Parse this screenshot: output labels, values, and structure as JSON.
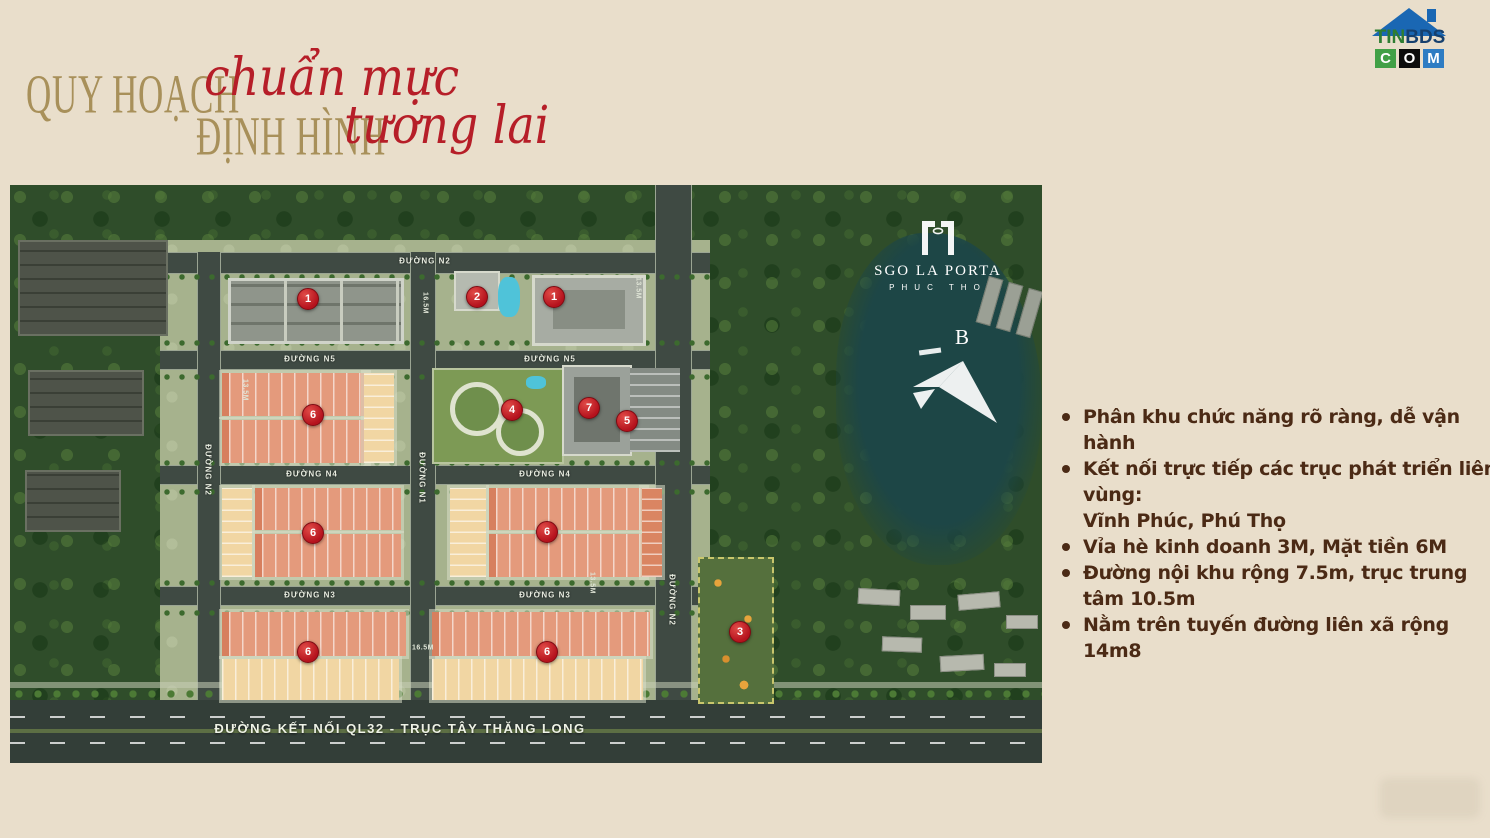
{
  "header": {
    "title_line1_gold": "QUY HOẠCH",
    "title_line1_red": "chuẩn mực",
    "title_line2_gold": "ĐỊNH HÌNH",
    "title_line2_red": "tương lai",
    "gold_color": "#a8905a",
    "red_color": "#b61e28"
  },
  "site_logo": {
    "part_green": "TIN",
    "part_dark": "BDS",
    "c": "C",
    "o": "O",
    "m": "M",
    "roof_color": "#1a67b3"
  },
  "features": {
    "text_color": "#4b2a15",
    "items": [
      "Phân khu chức năng rõ ràng, dễ vận hành",
      "Kết nối trực tiếp các trục phát triển liên vùng:\nVĩnh Phúc, Phú Thọ",
      "Vỉa hè kinh doanh 3M, Mặt tiền 6M",
      "Đường nội khu rộng 7.5m, trục trung tâm 10.5m",
      "Nằm trên tuyến đường liên xã rộng 14m8"
    ]
  },
  "map": {
    "project_logo": {
      "name": "SGO LA PORTA",
      "subtitle": "PHUC THO"
    },
    "north_label": "B",
    "bottom_road_label": "ĐƯỜNG KẾT NỐI QL32 - TRỤC TÂY THĂNG LONG",
    "marker_color": "#bb1a22",
    "road_labels": [
      {
        "text": "ĐƯỜNG N2",
        "x": 415,
        "y": 76,
        "vertical": false
      },
      {
        "text": "ĐƯỜNG N5",
        "x": 300,
        "y": 174,
        "vertical": false
      },
      {
        "text": "ĐƯỜNG N5",
        "x": 540,
        "y": 174,
        "vertical": false
      },
      {
        "text": "ĐƯỜNG N4",
        "x": 302,
        "y": 289,
        "vertical": false
      },
      {
        "text": "ĐƯỜNG N4",
        "x": 535,
        "y": 289,
        "vertical": false
      },
      {
        "text": "ĐƯỜNG N3",
        "x": 300,
        "y": 410,
        "vertical": false
      },
      {
        "text": "ĐƯỜNG N3",
        "x": 535,
        "y": 410,
        "vertical": false
      },
      {
        "text": "ĐƯỜNG N2",
        "x": 198,
        "y": 285,
        "vertical": true
      },
      {
        "text": "ĐƯỜNG N1",
        "x": 412,
        "y": 293,
        "vertical": true
      },
      {
        "text": "ĐƯỜNG N2",
        "x": 662,
        "y": 415,
        "vertical": true
      }
    ],
    "dimension_labels": [
      {
        "text": "16.5M",
        "x": 415,
        "y": 118,
        "vertical": true
      },
      {
        "text": "13.5M",
        "x": 628,
        "y": 103,
        "vertical": true
      },
      {
        "text": "13.5M",
        "x": 235,
        "y": 205,
        "vertical": true
      },
      {
        "text": "13.5M",
        "x": 582,
        "y": 398,
        "vertical": true
      },
      {
        "text": "16.5M",
        "x": 413,
        "y": 463,
        "vertical": false
      }
    ],
    "markers": [
      {
        "label": "1",
        "x": 298,
        "y": 114
      },
      {
        "label": "2",
        "x": 467,
        "y": 112
      },
      {
        "label": "1",
        "x": 544,
        "y": 112
      },
      {
        "label": "6",
        "x": 303,
        "y": 230
      },
      {
        "label": "4",
        "x": 502,
        "y": 225
      },
      {
        "label": "7",
        "x": 579,
        "y": 223
      },
      {
        "label": "5",
        "x": 617,
        "y": 236
      },
      {
        "label": "6",
        "x": 303,
        "y": 348
      },
      {
        "label": "6",
        "x": 537,
        "y": 347
      },
      {
        "label": "6",
        "x": 298,
        "y": 467
      },
      {
        "label": "6",
        "x": 537,
        "y": 467
      },
      {
        "label": "3",
        "x": 730,
        "y": 447
      }
    ]
  }
}
